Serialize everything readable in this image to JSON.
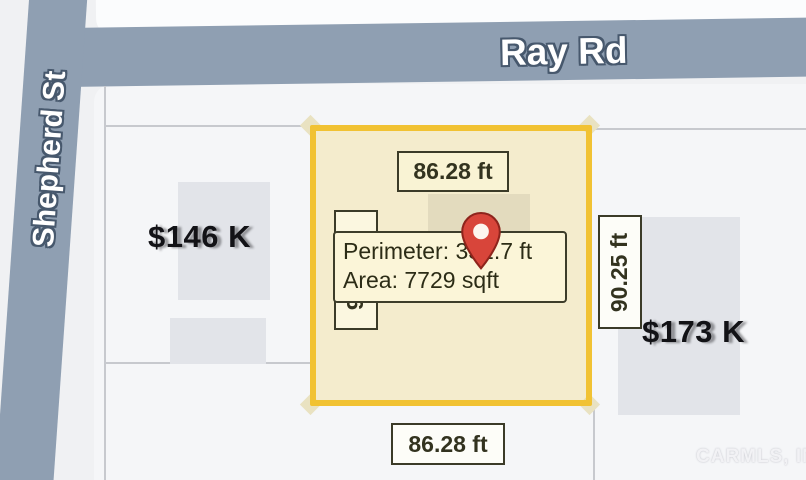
{
  "map": {
    "roads": {
      "horizontal": "Ray Rd",
      "vertical": "Shepherd St"
    },
    "parcel": {
      "width_top": "86.28 ft",
      "width_bottom": "86.28 ft",
      "height_right": "90.25 ft",
      "height_left": "90.25 ft",
      "tooltip": {
        "perimeter_line": "Perimeter: 351.7 ft",
        "area_line": "Area: 7729 sqft"
      }
    },
    "listings": {
      "left_price": "$146 K",
      "right_price": "$173 K"
    },
    "watermark": "CARMLS, INC",
    "colors": {
      "parcel_border": "#F1C233",
      "parcel_fill": "#F6EFC9",
      "road": "#8F9FB2",
      "pin_red": "#D8453A"
    }
  }
}
